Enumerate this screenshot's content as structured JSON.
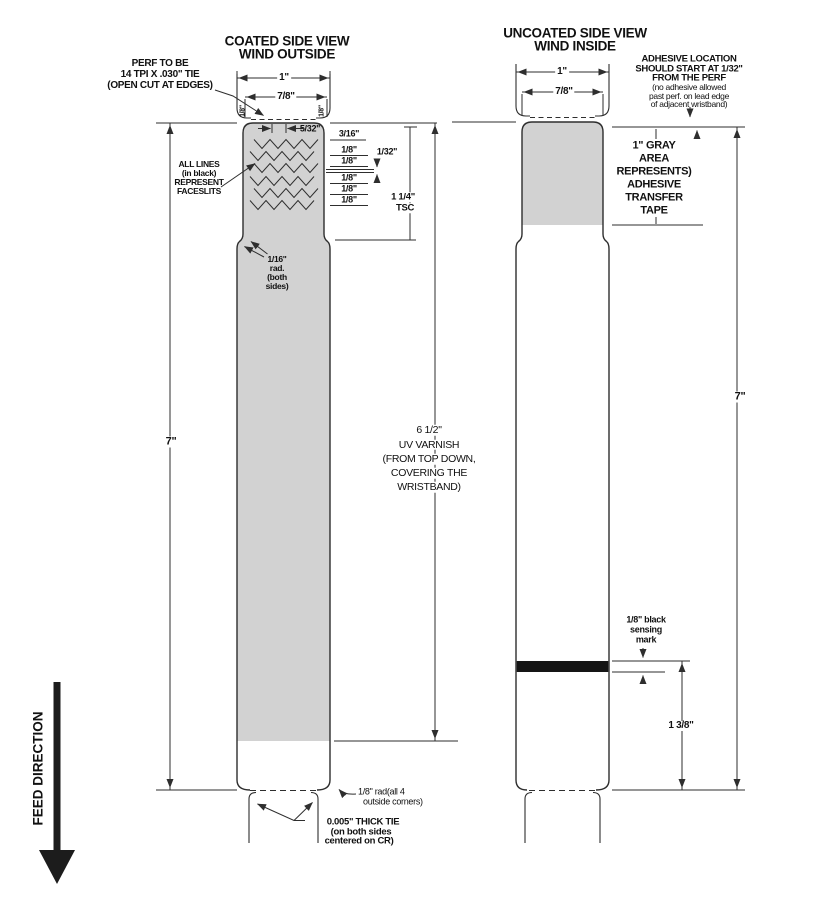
{
  "feed_direction": "FEED DIRECTION",
  "left_view": {
    "title_line1": "COATED SIDE VIEW",
    "title_line2": "WIND OUTSIDE",
    "perf_note": [
      "PERF TO BE",
      "14 TPI X .030\" TIE",
      "(OPEN CUT AT EDGES)"
    ],
    "dim_1in": "1\"",
    "dim_78": "7/8\"",
    "edge_tie_left": "1/8\"",
    "edge_tie_right": "1/8\"",
    "dim_532": "5/32\"",
    "slit_dims": [
      "3/16\"",
      "1/8\"",
      "1/8\"",
      "1/8\"",
      "1/8\"",
      "1/8\""
    ],
    "dim_132": "1/32\"",
    "dim_tsc": [
      "1 1/4\"",
      "TSC"
    ],
    "faceslits_note": [
      "ALL LINES",
      "(in black)",
      "REPRESENT",
      "FACESLITS"
    ],
    "rad_note": [
      "1/16\"",
      "rad.",
      "(both",
      "sides)"
    ],
    "dim_7in": "7\"",
    "varnish_note": [
      "6 1/2\"",
      "UV VARNISH",
      "(FROM TOP DOWN,",
      "COVERING THE",
      "WRISTBAND)"
    ],
    "corner_rad_note": [
      "1/8\" rad(all 4",
      "outside corners)"
    ],
    "tie_note": [
      "0.005\" THICK TIE",
      "(on both sides",
      "centered on CR)"
    ]
  },
  "right_view": {
    "title_line1": "UNCOATED SIDE VIEW",
    "title_line2": "WIND INSIDE",
    "dim_1in": "1\"",
    "dim_78": "7/8\"",
    "adhesive_note_bold": [
      "ADHESIVE LOCATION",
      "SHOULD START AT 1/32\"",
      "FROM THE PERF"
    ],
    "adhesive_note_small": [
      "(no adhesive allowed",
      "past perf. on lead edge",
      "of adjacent wristband)"
    ],
    "gray_area_note": [
      "1\" GRAY",
      "AREA",
      "REPRESENTS)",
      "ADHESIVE",
      "TRANSFER",
      "TAPE"
    ],
    "dim_7in": "7\"",
    "sensing_note": [
      "1/8\" black",
      "sensing",
      "mark"
    ],
    "dim_138": "1 3/8\""
  },
  "colors": {
    "line": "#2e2e2e",
    "gray_fill": "#d2d2d2",
    "black_mark": "#151515"
  }
}
